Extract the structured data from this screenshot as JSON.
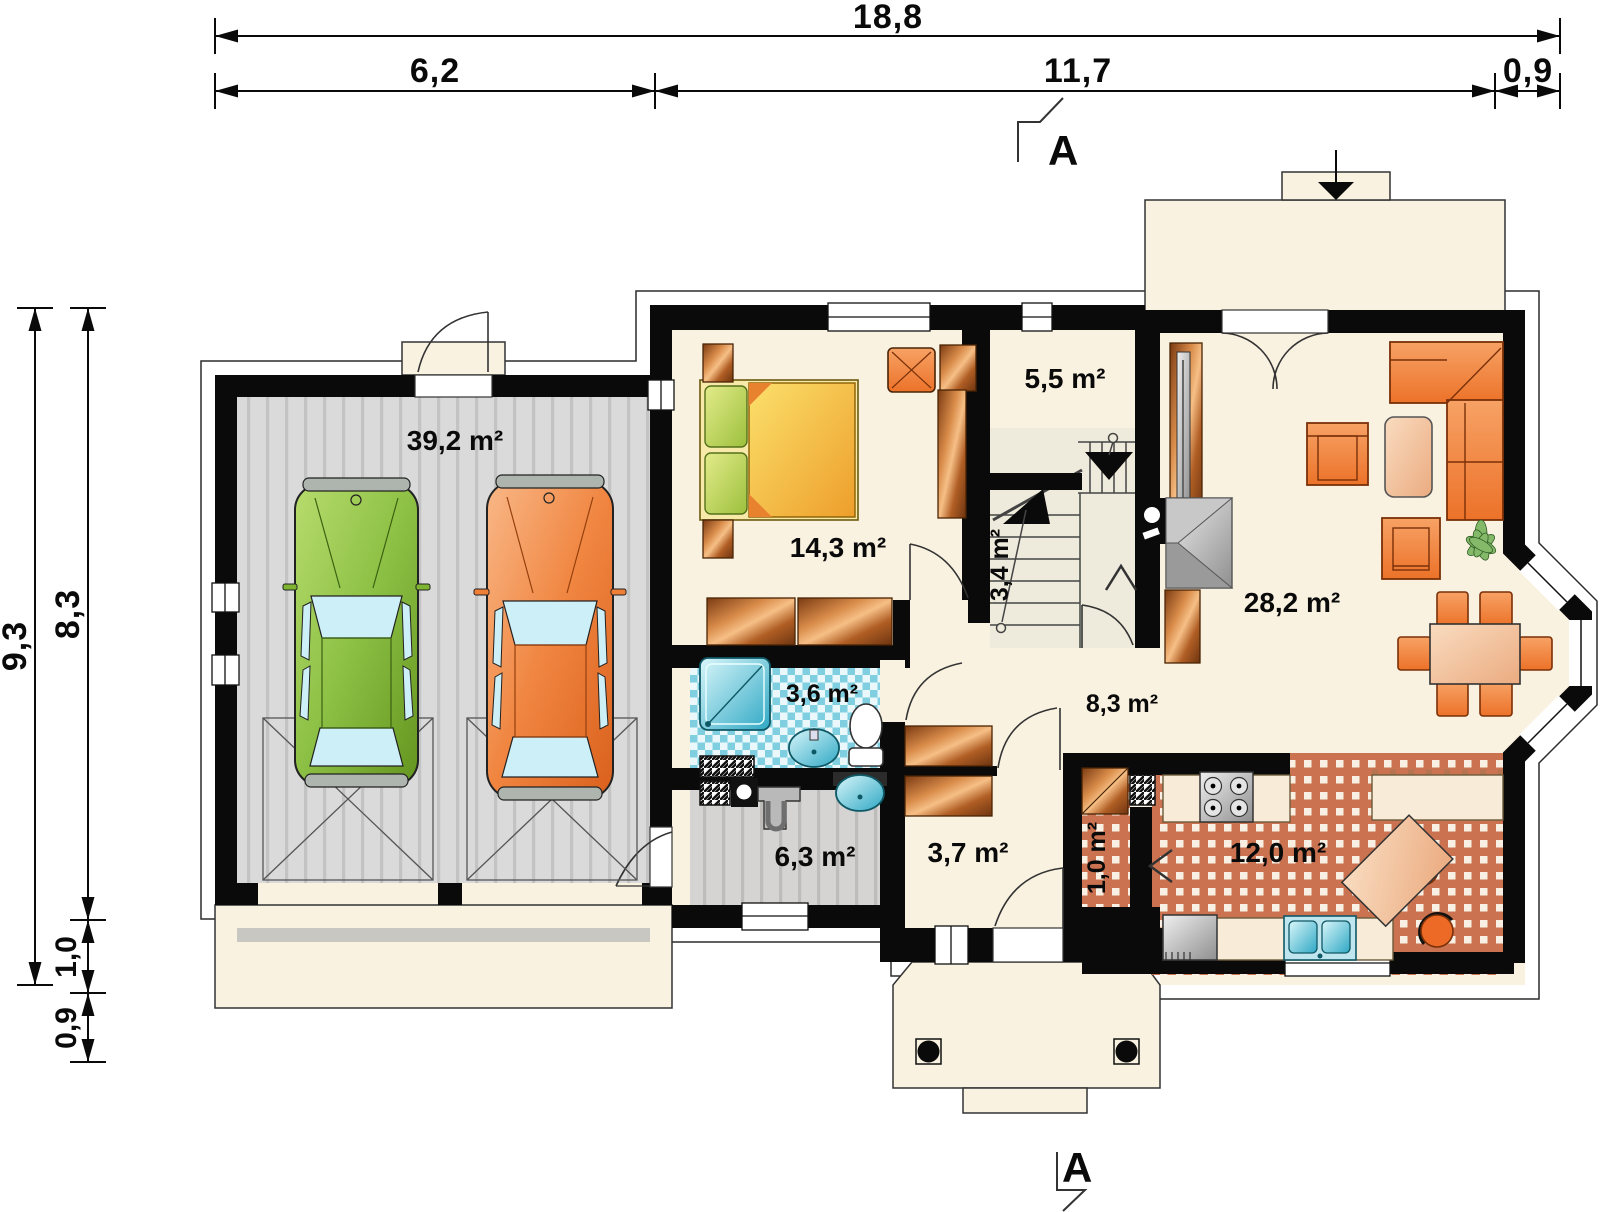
{
  "plan": {
    "title": "house ground floor plan",
    "section_label": "A",
    "dimensions_top": {
      "total": "18,8",
      "segments": [
        "6,2",
        "11,7",
        "0,9"
      ]
    },
    "dimensions_left": {
      "total": "9,3",
      "segments": [
        "8,3",
        "1,0",
        "0,9"
      ]
    },
    "rooms": {
      "garage": "39,2 m²",
      "bedroom": "14,3 m²",
      "storage": "5,5 m²",
      "stairs": "3,4 m²",
      "living": "28,2 m²",
      "bathroom": "3,6 m²",
      "hall": "8,3 m²",
      "utility": "6,3 m²",
      "vestibule": "3,7 m²",
      "pantry": "1,0 m²",
      "kitchen": "12,0 m²"
    },
    "icons": [
      "car-green-icon",
      "car-orange-icon",
      "double-bed-icon",
      "wardrobe-icon",
      "desk-chair-icon",
      "corner-sofa-icon",
      "armchair-icon",
      "coffee-table-icon",
      "dining-table-icon",
      "plant-icon",
      "fireplace-icon",
      "stairs-icon",
      "shower-icon",
      "toilet-icon",
      "washbasin-icon",
      "boiler-icon",
      "gas-stove-icon",
      "kitchen-sink-icon",
      "fridge-icon",
      "porch-column-icon",
      "terrace-arrow-icon"
    ],
    "colors": {
      "wall": "#0a0a0a",
      "floor_cream": "#FAF2E1",
      "garage_floor": "#DADADA",
      "bath_check": "#7FCFE0",
      "kitchen_check": "#CB7350",
      "furniture_orange": "#EE7F35",
      "furniture_copper": "#C06A28",
      "bed_yellow": "#F5C832",
      "pillow_green": "#A8C445",
      "fixture_teal": "#3FB4CC",
      "car_green": "#7FB431",
      "car_orange": "#EE7F35",
      "stair_floor": "#EFEBDC"
    }
  }
}
